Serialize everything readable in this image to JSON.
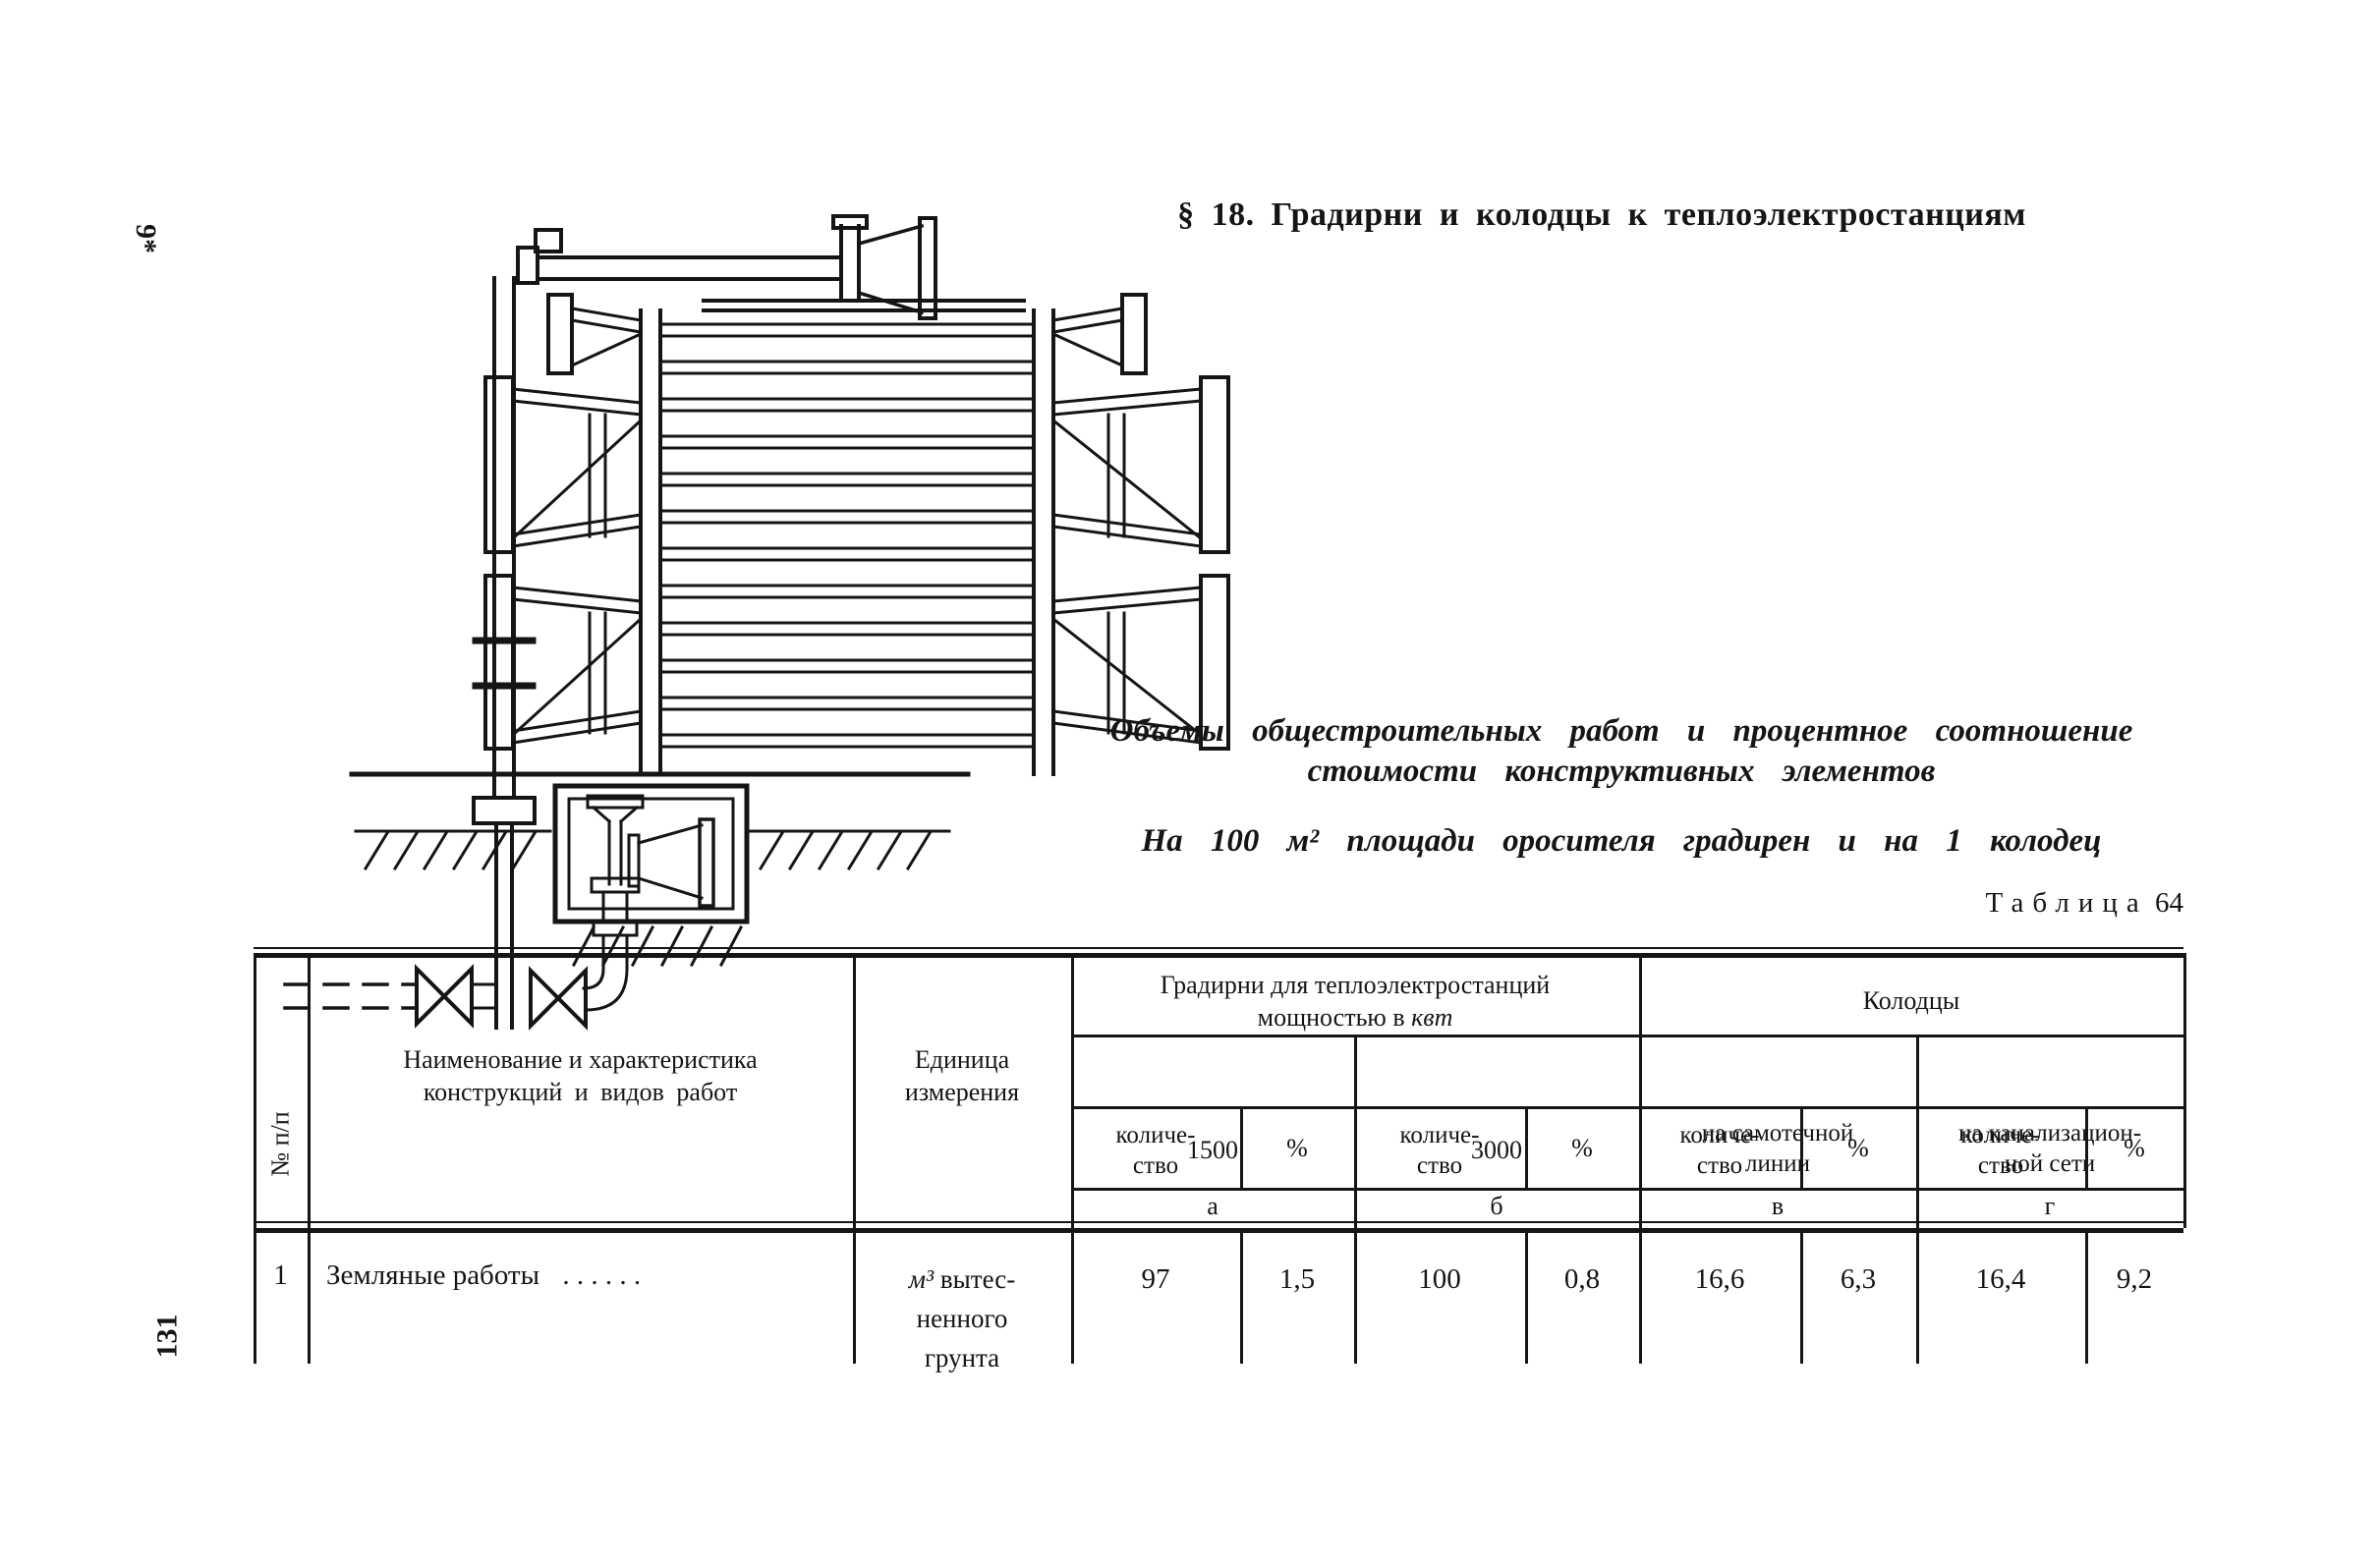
{
  "page": {
    "signature_mark": "9*",
    "page_number": "131",
    "section_heading": "§ 18. Градирни и колодцы к теплоэлектростанциям",
    "caption": {
      "line1": "Объемы общестроительных работ и процентное соотношение",
      "line2": "стоимости конструктивных элементов",
      "subtitle": "На 100 м² площади оросителя градирен и на 1 колодец"
    },
    "table_label": {
      "word": "Таблица",
      "number": "64"
    }
  },
  "table": {
    "header": {
      "num": "№ п/п",
      "name_line1": "Наименование и характеристика",
      "name_line2": "конструкций и видов работ",
      "unit_line1": "Единица",
      "unit_line2": "измерения",
      "group_gradirni_line1": "Градирни для теплоэлектростанций",
      "group_gradirni_line2_pre": "мощностью в ",
      "group_gradirni_line2_unit": "квт",
      "group_kolodtsy": "Колодцы",
      "power_1500": "1500",
      "power_3000": "3000",
      "well_gravity_line1": "на самотечной",
      "well_gravity_line2": "линии",
      "well_sewer_line1": "на канализацион-",
      "well_sewer_line2": "ной сети",
      "qty_line1": "количе-",
      "qty_line2": "ство",
      "pct": "%",
      "letter_a": "а",
      "letter_b": "б",
      "letter_v": "в",
      "letter_g": "г"
    },
    "rows": [
      {
        "num": "1",
        "name": "Земляные работы",
        "dots": ". . . . . .",
        "unit_it": "м³",
        "unit_rest": "вытес-",
        "unit_line2": "ненного",
        "unit_line3": "грунта",
        "values": [
          "97",
          "1,5",
          "100",
          "0,8",
          "16,6",
          "6,3",
          "16,4",
          "9,2"
        ]
      }
    ]
  }
}
